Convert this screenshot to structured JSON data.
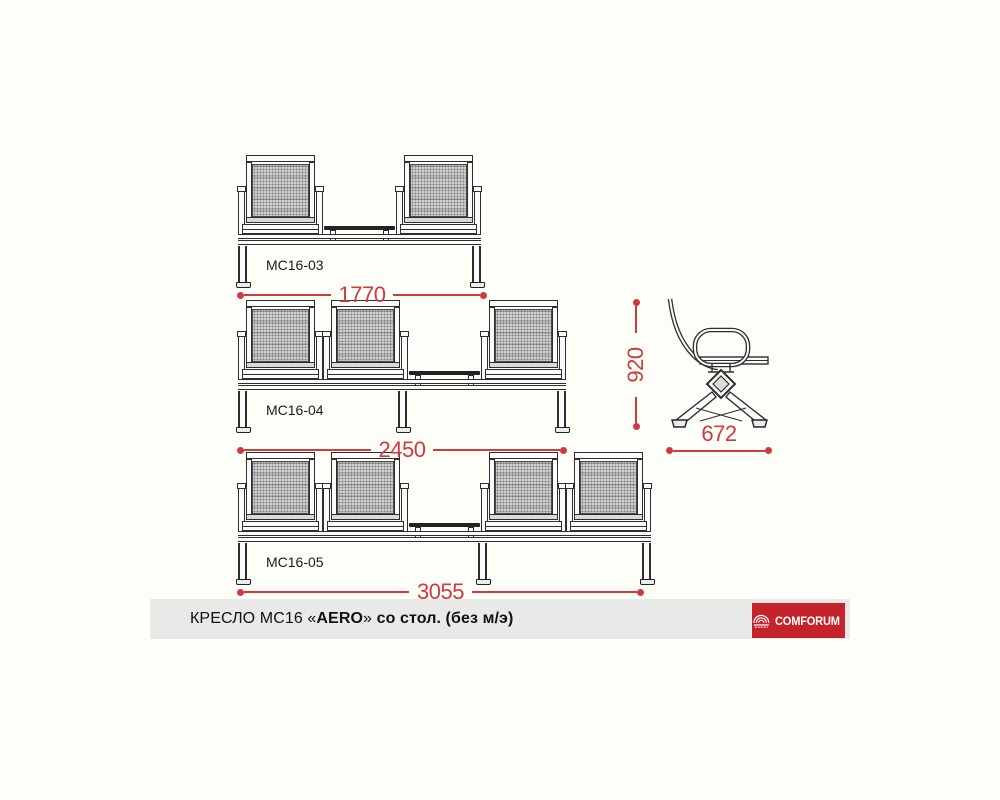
{
  "page": {
    "background": "#fdfef8"
  },
  "drawing": {
    "line_color": "#2e2e2e",
    "dimension_color": "#cf3a3e",
    "benches": [
      {
        "model": "МС16-03",
        "seats": 2,
        "length_mm": "1770"
      },
      {
        "model": "МС16-04",
        "seats": 3,
        "length_mm": "2450"
      },
      {
        "model": "МС16-05",
        "seats": 4,
        "length_mm": "3055"
      }
    ],
    "side_view": {
      "height_mm": "920",
      "depth_mm": "672"
    }
  },
  "title_bar": {
    "segments": {
      "prefix": "КРЕСЛО МС16 «",
      "model": "AERO",
      "mid": "»",
      "suffix": " со стол. (без м/э)"
    },
    "background": "#e9e9e7",
    "logo": {
      "text": "COMFORUM",
      "background": "#c4232c",
      "icon": "amphitheater-arcs-icon"
    }
  }
}
